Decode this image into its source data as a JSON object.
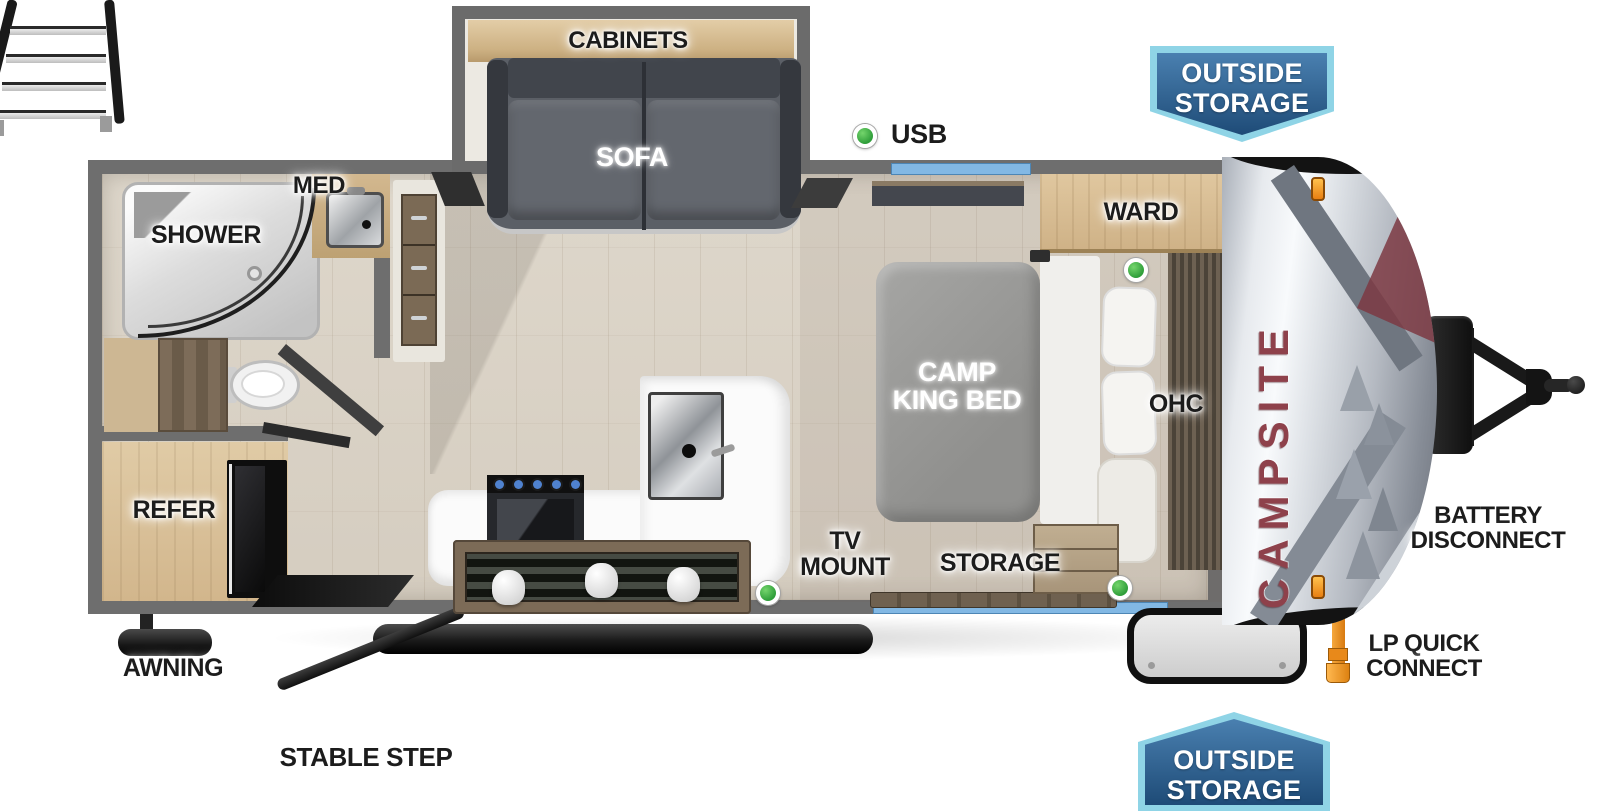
{
  "title": "Campsite travel trailer floor plan",
  "brand": {
    "logo_text": "CAMPSITE"
  },
  "badges": {
    "outside_storage_top": {
      "line1": "OUTSIDE",
      "line2": "STORAGE"
    },
    "outside_storage_bottom": {
      "line1": "OUTSIDE",
      "line2": "STORAGE"
    }
  },
  "labels": {
    "cabinets": "CABINETS",
    "sofa": "SOFA",
    "usb": "USB",
    "med": "MED",
    "shower": "SHOWER",
    "ward": "WARD",
    "ohc": "OHC",
    "bed_line1": "CAMP",
    "bed_line2": "KING BED",
    "tv_line1": "TV",
    "tv_line2": "MOUNT",
    "storage": "STORAGE",
    "refer": "REFER",
    "awning": "AWNING",
    "stable_step": "STABLE STEP",
    "battery_line1": "BATTERY",
    "battery_line2": "DISCONNECT",
    "lp_line1": "LP QUICK",
    "lp_line2": "CONNECT"
  },
  "colors": {
    "wall_gray": "#6e6e6e",
    "floor_wood": "#d8d1c6",
    "window_blue": "#82b8e4",
    "indicator_green": "#3db549",
    "badge_border": "#8fd4e6",
    "badge_fill_top": "#4a80b0",
    "badge_fill_bottom": "#1e4b77",
    "logo_red": "#8e414b",
    "lp_orange": "#e8891a"
  }
}
